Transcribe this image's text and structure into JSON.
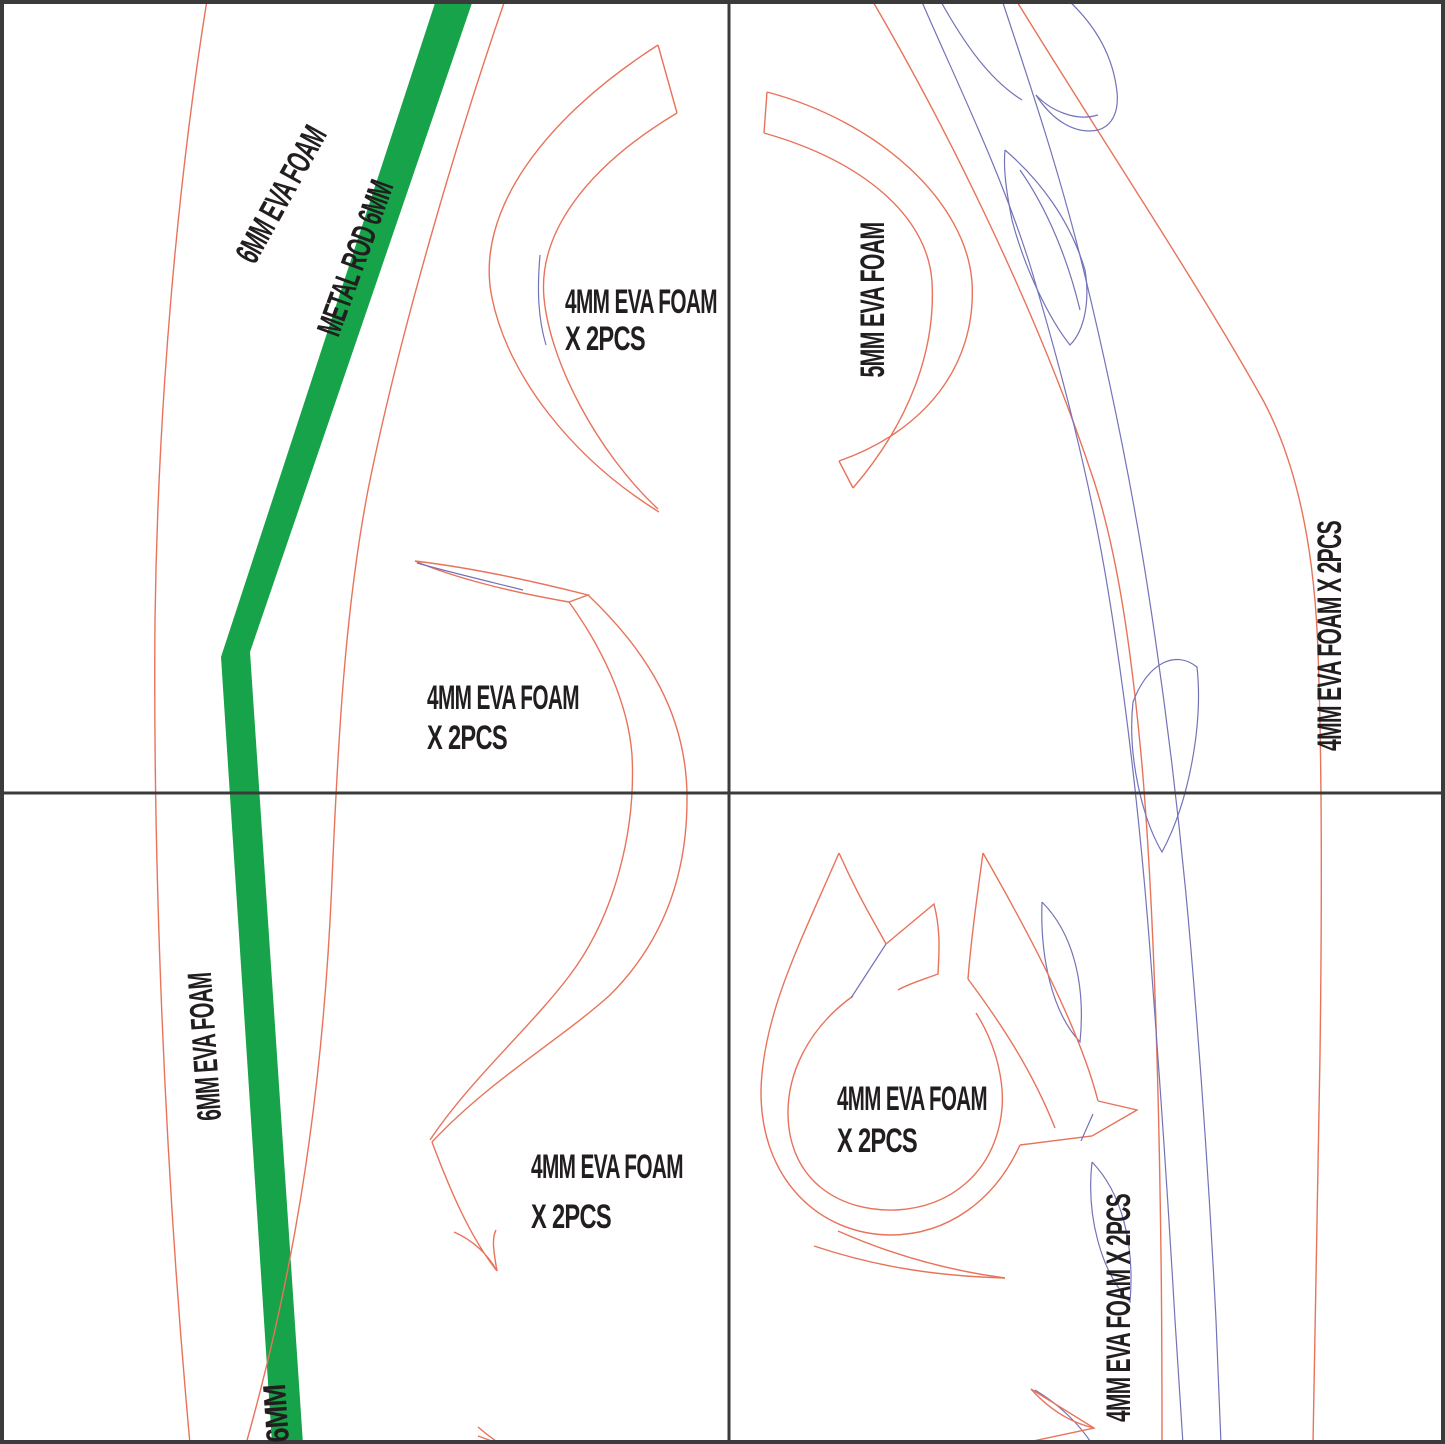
{
  "document": {
    "type": "cosplay EVA foam weapon pattern sheet",
    "quadrants": 4
  },
  "colors": {
    "pattern_outline_red": "#E8735A",
    "detail_blue": "#7373B8",
    "metal_rod_green": "#17A34A",
    "text_black": "#221E1F",
    "divider_dark": "#3B3B3B",
    "paper_white": "#FFFFFF"
  },
  "labels": {
    "piece_6mm_foam_top": "6MM EVA FOAM",
    "metal_rod": "METAL ROD 6MM",
    "crescent_l1": "4MM EVA FOAM",
    "crescent_l2": "X 2PCS",
    "tl_blade_l1": "4MM EVA FOAM",
    "tl_blade_l2": "X 2PCS",
    "piece_5mm_foam": "5MM EVA FOAM",
    "tr_blade_vertical": "4MM EVA FOAM X 2PCS",
    "piece_6mm_foam_bottom": "6MM EVA FOAM",
    "bl_blade_l1": "4MM EVA FOAM",
    "bl_blade_l2": "X 2PCS",
    "ring_l1": "4MM EVA FOAM",
    "ring_l2": "X 2PCS",
    "br_blade_vertical": "4MM EVA FOAM X 2PCS",
    "rod_width_6mm": "6MM"
  }
}
